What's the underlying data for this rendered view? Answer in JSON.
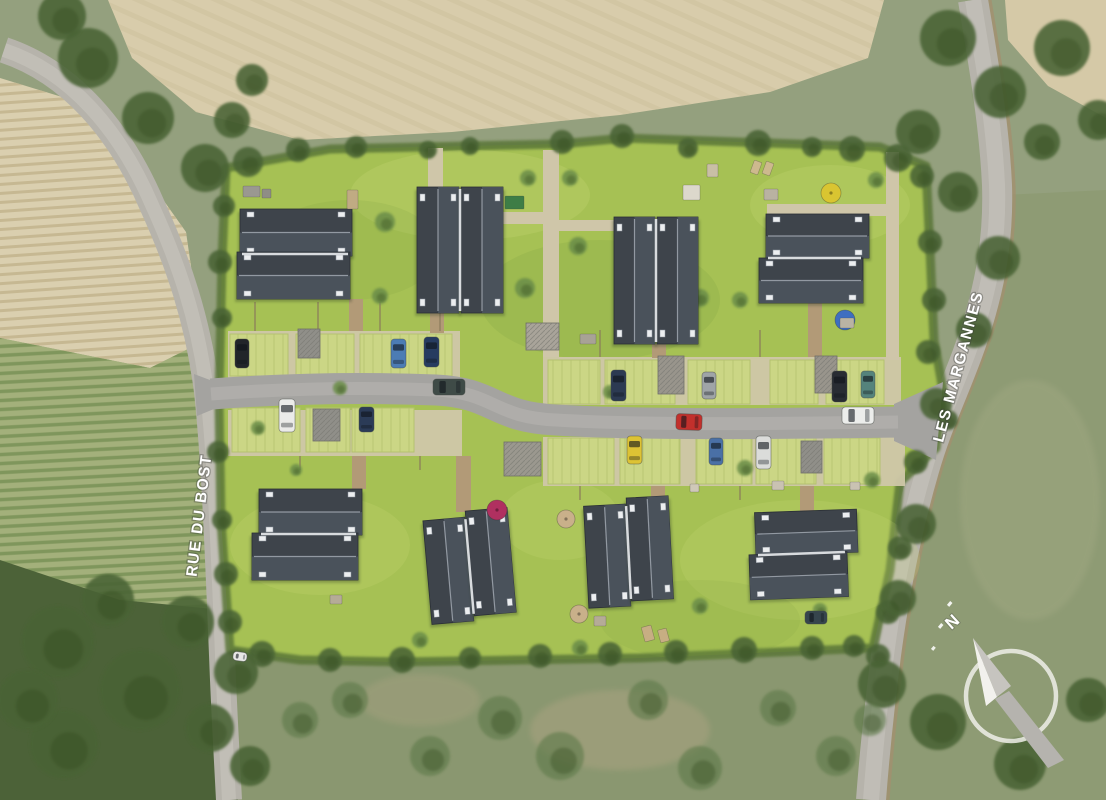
{
  "labels": {
    "street_left": "RUE DU BOST",
    "street_right": "LES MARGANNES",
    "compass_north": "N"
  },
  "colors": {
    "lawn": "#a6c154",
    "lawnLight": "#d3e07e",
    "lawnDark": "#7f9f41",
    "roofDark": "#3e444b",
    "roofLight": "#4a525b",
    "ridge": "#9ba2ab",
    "sharedRidge": "#d8dbde",
    "chimney": "#eceef0",
    "roadAsphalt": "#a4a3a0",
    "roadCenter": "#b8b7b3",
    "outerRoad": "#b6b3ab",
    "outerRoadCenter": "#c6c3bb",
    "shoulder": "#a2906f",
    "pathBeige": "#cfc6a9",
    "pathTan": "#b29a77",
    "apron": "#cfc7a9",
    "paver": "#cbd685",
    "paverLine": "#b4c26f",
    "hedge": "#5a7638",
    "fence": "#8a7b5c",
    "treeDark": "#4a6336",
    "treeMid": "#6c8e48",
    "treeScrub": "#5d7949",
    "fieldTop": "#d8ccab",
    "fieldLeft": "#dacfaf",
    "vineyard": "#a3b07b",
    "woods": "#4c6238",
    "fieldRight": "#8e9b74",
    "scrub": "#8a9770",
    "compassWhite": "#f2f1ed",
    "compassGray": "#b5b3ae",
    "label": "#ffffff"
  },
  "scene": {
    "clusters": [
      {
        "rot": 0,
        "axis": "h",
        "b": [
          [
            240,
            209,
            112,
            47
          ],
          [
            237,
            252,
            113,
            47
          ]
        ]
      },
      {
        "rot": 0,
        "axis": "v",
        "b": [
          [
            417,
            187,
            42,
            126
          ],
          [
            461,
            187,
            42,
            126
          ]
        ]
      },
      {
        "rot": 0,
        "axis": "v",
        "b": [
          [
            614,
            217,
            41,
            127
          ],
          [
            657,
            217,
            41,
            127
          ]
        ]
      },
      {
        "rot": 0,
        "axis": "h",
        "b": [
          [
            766,
            214,
            103,
            44
          ],
          [
            759,
            258,
            104,
            45
          ]
        ]
      },
      {
        "rot": 0,
        "axis": "h",
        "b": [
          [
            259,
            489,
            103,
            46
          ],
          [
            252,
            533,
            106,
            47
          ]
        ]
      },
      {
        "rot": -5,
        "axis": "v",
        "b": [
          [
            427,
            517,
            42,
            104
          ],
          [
            470,
            511,
            42,
            105
          ]
        ]
      },
      {
        "rot": -3,
        "axis": "v",
        "b": [
          [
            586,
            504,
            42,
            102
          ],
          [
            629,
            498,
            42,
            103
          ]
        ]
      },
      {
        "rot": -2,
        "axis": "h",
        "b": [
          [
            756,
            511,
            102,
            43
          ],
          [
            749,
            553,
            98,
            45
          ]
        ]
      }
    ],
    "cars": [
      [
        433,
        379,
        32,
        16,
        "#3f4b47",
        0
      ],
      [
        676,
        414,
        26,
        16,
        "#c2302c",
        2
      ],
      [
        842,
        407,
        32,
        17,
        "#ecedeb",
        0
      ],
      [
        235,
        339,
        14,
        29,
        "#22252a",
        0
      ],
      [
        391,
        339,
        15,
        29,
        "#4c7cb4",
        0
      ],
      [
        424,
        337,
        15,
        30,
        "#273c60",
        0
      ],
      [
        611,
        370,
        15,
        31,
        "#2c3a52",
        0
      ],
      [
        702,
        372,
        14,
        27,
        "#9fa4a7",
        0
      ],
      [
        832,
        371,
        15,
        31,
        "#282c33",
        0
      ],
      [
        861,
        371,
        14,
        27,
        "#55837c",
        0
      ],
      [
        279,
        399,
        16,
        33,
        "#ebebe9",
        0
      ],
      [
        359,
        407,
        15,
        25,
        "#2b3b57",
        0
      ],
      [
        627,
        436,
        15,
        28,
        "#ddc334",
        0
      ],
      [
        709,
        438,
        14,
        27,
        "#4a70a6",
        0
      ],
      [
        756,
        436,
        15,
        33,
        "#dbdcda",
        0
      ],
      [
        805,
        611,
        22,
        13,
        "#36454d",
        0
      ],
      [
        233,
        652,
        14,
        9,
        "#e8e8e6",
        8
      ]
    ],
    "sheds": [
      [
        298,
        329,
        22,
        29,
        "#908f89",
        "v"
      ],
      [
        313,
        409,
        27,
        32,
        "#908f89",
        "v"
      ],
      [
        504,
        442,
        37,
        34,
        "#9b988f",
        "v"
      ],
      [
        658,
        356,
        26,
        38,
        "#99958c",
        "v"
      ],
      [
        815,
        356,
        22,
        37,
        "#99958c",
        "v"
      ],
      [
        801,
        441,
        21,
        32,
        "#908f89",
        "v"
      ],
      [
        526,
        323,
        33,
        27,
        "#a9a49a",
        "h"
      ]
    ],
    "parasols": [
      [
        831,
        193,
        10,
        "#d9c531"
      ],
      [
        845,
        320,
        10,
        "#3e6ec0"
      ],
      [
        497,
        510,
        10,
        "#b03060"
      ],
      [
        566,
        519,
        9,
        "#c9b08a"
      ],
      [
        579,
        614,
        9,
        "#c9b08a"
      ]
    ],
    "furniture": [
      [
        707,
        164,
        11,
        13,
        "#c9bfa5",
        0
      ],
      [
        752,
        161,
        8,
        13,
        "#cdb98e",
        20
      ],
      [
        764,
        162,
        8,
        13,
        "#cdb98e",
        20
      ],
      [
        683,
        185,
        17,
        15,
        "#dcd8cc",
        0
      ],
      [
        764,
        189,
        14,
        11,
        "#b9b2a2",
        0
      ],
      [
        243,
        186,
        17,
        11,
        "#9a9891",
        0
      ],
      [
        262,
        189,
        9,
        9,
        "#8f8d86",
        0
      ],
      [
        347,
        190,
        11,
        19,
        "#c0ab83",
        0
      ],
      [
        505,
        196,
        19,
        13,
        "#3e7d46",
        0
      ],
      [
        643,
        626,
        10,
        15,
        "#c7ae83",
        -15
      ],
      [
        659,
        629,
        9,
        13,
        "#c7ae83",
        -15
      ],
      [
        594,
        616,
        12,
        10,
        "#b5ab97",
        0
      ],
      [
        772,
        481,
        12,
        9,
        "#c9c2b2",
        0
      ],
      [
        850,
        482,
        10,
        8,
        "#c9c2b2",
        0
      ],
      [
        690,
        484,
        9,
        8,
        "#cfc8b8",
        0
      ],
      [
        330,
        595,
        12,
        9,
        "#b5ab97",
        0
      ],
      [
        840,
        318,
        14,
        10,
        "#b9b3a4",
        0
      ],
      [
        580,
        334,
        16,
        10,
        "#a8a296",
        0
      ]
    ],
    "bays": [
      [
        230,
        334,
        58,
        42
      ],
      [
        296,
        334,
        58,
        42
      ],
      [
        360,
        334,
        92,
        42
      ],
      [
        548,
        360,
        52,
        44
      ],
      [
        605,
        360,
        70,
        44
      ],
      [
        688,
        360,
        62,
        44
      ],
      [
        770,
        360,
        48,
        44
      ],
      [
        826,
        360,
        58,
        44
      ],
      [
        232,
        408,
        68,
        44
      ],
      [
        306,
        408,
        44,
        44
      ],
      [
        352,
        408,
        62,
        44
      ],
      [
        548,
        438,
        66,
        46
      ],
      [
        620,
        438,
        60,
        46
      ],
      [
        696,
        438,
        56,
        46
      ],
      [
        756,
        438,
        60,
        46
      ],
      [
        824,
        438,
        56,
        46
      ]
    ],
    "paths_beige": [
      [
        543,
        150,
        16,
        207
      ],
      [
        500,
        212,
        44,
        12
      ],
      [
        428,
        148,
        15,
        44
      ],
      [
        886,
        152,
        13,
        208
      ],
      [
        767,
        204,
        120,
        12
      ],
      [
        557,
        220,
        58,
        11
      ]
    ],
    "paths_tan": [
      [
        349,
        299,
        14,
        32
      ],
      [
        430,
        313,
        14,
        20
      ],
      [
        652,
        344,
        14,
        14
      ],
      [
        808,
        303,
        14,
        54
      ],
      [
        352,
        456,
        14,
        33
      ],
      [
        456,
        456,
        15,
        56
      ],
      [
        651,
        486,
        14,
        14
      ],
      [
        800,
        486,
        14,
        25
      ]
    ],
    "hedges": [
      [
        368,
        154,
        368,
        298
      ],
      [
        575,
        214,
        575,
        312
      ],
      [
        600,
        152,
        600,
        212
      ],
      [
        710,
        152,
        710,
        210
      ],
      [
        748,
        152,
        748,
        210
      ],
      [
        700,
        211,
        762,
        211
      ],
      [
        880,
        154,
        880,
        356
      ],
      [
        583,
        244,
        640,
        244
      ],
      [
        583,
        330,
        642,
        330
      ],
      [
        388,
        468,
        388,
        650
      ],
      [
        540,
        470,
        540,
        648
      ],
      [
        700,
        470,
        700,
        648
      ],
      [
        736,
        470,
        736,
        562
      ],
      [
        670,
        531,
        734,
        531
      ],
      [
        875,
        462,
        875,
        558
      ],
      [
        252,
        584,
        362,
        584
      ]
    ],
    "fences": [
      [
        255,
        302,
        255,
        331
      ],
      [
        318,
        302,
        318,
        331
      ],
      [
        380,
        302,
        380,
        331
      ],
      [
        440,
        302,
        440,
        331
      ],
      [
        600,
        330,
        600,
        357
      ],
      [
        760,
        330,
        760,
        357
      ],
      [
        300,
        456,
        300,
        470
      ],
      [
        420,
        456,
        420,
        470
      ],
      [
        580,
        486,
        580,
        500
      ],
      [
        740,
        486,
        740,
        500
      ]
    ],
    "trees": [
      [
        248,
        162,
        15,
        "d"
      ],
      [
        298,
        150,
        12,
        "d"
      ],
      [
        356,
        147,
        11,
        "d"
      ],
      [
        428,
        150,
        9,
        "d"
      ],
      [
        470,
        146,
        9,
        "d"
      ],
      [
        562,
        142,
        12,
        "d"
      ],
      [
        622,
        136,
        12,
        "d"
      ],
      [
        688,
        148,
        10,
        "d"
      ],
      [
        758,
        143,
        13,
        "d"
      ],
      [
        812,
        147,
        10,
        "d"
      ],
      [
        852,
        149,
        13,
        "d"
      ],
      [
        898,
        158,
        14,
        "d"
      ],
      [
        922,
        176,
        12,
        "d"
      ],
      [
        224,
        206,
        11,
        "d"
      ],
      [
        220,
        262,
        12,
        "d"
      ],
      [
        222,
        318,
        10,
        "d"
      ],
      [
        218,
        452,
        11,
        "d"
      ],
      [
        222,
        520,
        10,
        "d"
      ],
      [
        226,
        574,
        12,
        "d"
      ],
      [
        230,
        622,
        12,
        "d"
      ],
      [
        930,
        242,
        12,
        "d"
      ],
      [
        934,
        300,
        12,
        "d"
      ],
      [
        928,
        352,
        12,
        "d"
      ],
      [
        948,
        420,
        10,
        "d"
      ],
      [
        916,
        462,
        12,
        "d"
      ],
      [
        900,
        548,
        12,
        "d"
      ],
      [
        888,
        612,
        12,
        "d"
      ],
      [
        878,
        656,
        12,
        "d"
      ],
      [
        262,
        654,
        13,
        "d"
      ],
      [
        330,
        660,
        12,
        "d"
      ],
      [
        402,
        660,
        13,
        "d"
      ],
      [
        470,
        658,
        11,
        "d"
      ],
      [
        540,
        656,
        12,
        "d"
      ],
      [
        610,
        654,
        12,
        "d"
      ],
      [
        676,
        652,
        12,
        "d"
      ],
      [
        744,
        650,
        13,
        "d"
      ],
      [
        812,
        648,
        12,
        "d"
      ],
      [
        854,
        646,
        11,
        "d"
      ],
      [
        385,
        222,
        10,
        "m"
      ],
      [
        380,
        296,
        8,
        "m"
      ],
      [
        525,
        288,
        10,
        "m"
      ],
      [
        578,
        246,
        9,
        "m"
      ],
      [
        570,
        178,
        8,
        "m"
      ],
      [
        700,
        298,
        9,
        "m"
      ],
      [
        740,
        300,
        8,
        "m"
      ],
      [
        528,
        178,
        8,
        "m"
      ],
      [
        610,
        392,
        7,
        "m"
      ],
      [
        745,
        468,
        8,
        "m"
      ],
      [
        700,
        606,
        8,
        "m"
      ],
      [
        340,
        388,
        7,
        "m"
      ],
      [
        258,
        428,
        7,
        "m"
      ],
      [
        296,
        470,
        6,
        "m"
      ],
      [
        872,
        480,
        8,
        "m"
      ],
      [
        820,
        610,
        7,
        "m"
      ],
      [
        420,
        640,
        8,
        "m"
      ],
      [
        580,
        648,
        8,
        "m"
      ],
      [
        876,
        180,
        8,
        "m"
      ],
      [
        88,
        58,
        30,
        "d"
      ],
      [
        148,
        118,
        26,
        "d"
      ],
      [
        205,
        168,
        24,
        "d"
      ],
      [
        62,
        16,
        24,
        "d"
      ],
      [
        232,
        120,
        18,
        "d"
      ],
      [
        252,
        80,
        16,
        "d"
      ],
      [
        948,
        38,
        28,
        "d"
      ],
      [
        1000,
        92,
        26,
        "d"
      ],
      [
        1062,
        48,
        28,
        "d"
      ],
      [
        918,
        132,
        22,
        "d"
      ],
      [
        958,
        192,
        20,
        "d"
      ],
      [
        1042,
        142,
        18,
        "d"
      ],
      [
        1098,
        120,
        20,
        "d"
      ],
      [
        998,
        258,
        22,
        "d"
      ],
      [
        974,
        330,
        18,
        "d"
      ],
      [
        936,
        404,
        16,
        "d"
      ],
      [
        916,
        524,
        20,
        "d"
      ],
      [
        898,
        598,
        18,
        "d"
      ],
      [
        882,
        684,
        24,
        "d"
      ],
      [
        938,
        722,
        28,
        "d"
      ],
      [
        1020,
        764,
        26,
        "d"
      ],
      [
        1088,
        700,
        22,
        "d"
      ],
      [
        58,
        642,
        36,
        "d"
      ],
      [
        140,
        690,
        40,
        "d"
      ],
      [
        64,
        744,
        34,
        "d"
      ],
      [
        188,
        622,
        26,
        "d"
      ],
      [
        236,
        672,
        22,
        "d"
      ],
      [
        108,
        600,
        26,
        "d"
      ],
      [
        28,
        700,
        30,
        "d"
      ],
      [
        210,
        728,
        24,
        "d"
      ],
      [
        250,
        766,
        20,
        "d"
      ],
      [
        350,
        700,
        18,
        "s"
      ],
      [
        500,
        718,
        22,
        "s"
      ],
      [
        648,
        700,
        20,
        "s"
      ],
      [
        778,
        708,
        18,
        "s"
      ],
      [
        560,
        756,
        24,
        "s"
      ],
      [
        700,
        768,
        22,
        "s"
      ],
      [
        430,
        756,
        20,
        "s"
      ],
      [
        300,
        720,
        18,
        "s"
      ],
      [
        836,
        756,
        20,
        "s"
      ],
      [
        870,
        720,
        16,
        "s"
      ]
    ]
  }
}
